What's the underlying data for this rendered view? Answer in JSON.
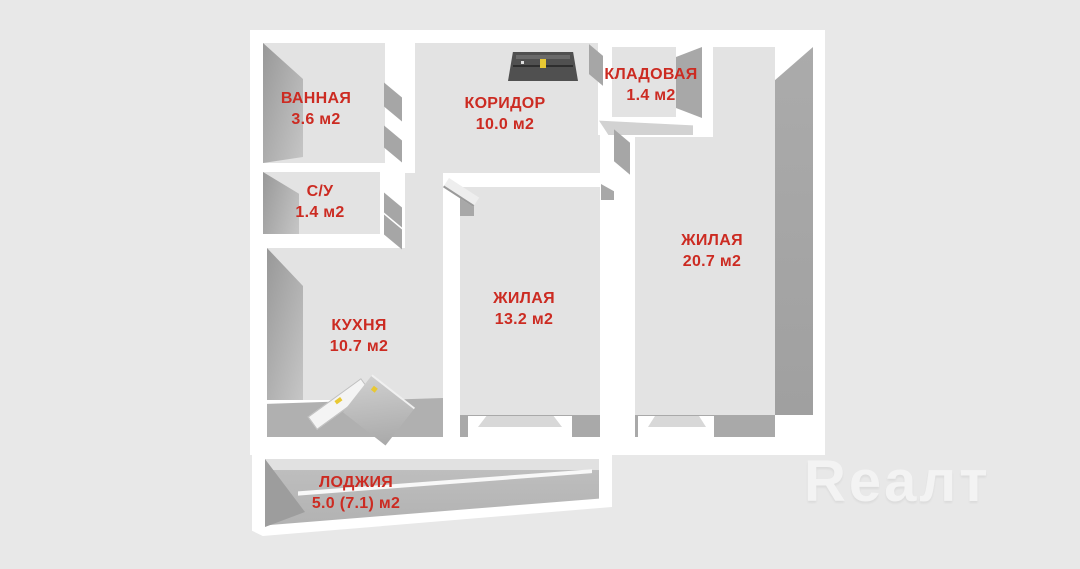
{
  "watermark": {
    "text": "Rеалт"
  },
  "colors": {
    "bg": "#e8e8e8",
    "wall": "#ffffff",
    "floor": "#e3e3e3",
    "facet": "#a8a8a8",
    "label_red": "#cc2b22",
    "door_dark": "#505050",
    "handle": "#e8c833",
    "watermark": "#f3f3f3"
  },
  "rooms": [
    {
      "key": "bathroom",
      "name": "ВАННАЯ",
      "area": "3.6 м2"
    },
    {
      "key": "wc",
      "name": "С/У",
      "area": "1.4 м2"
    },
    {
      "key": "corridor",
      "name": "КОРИДОР",
      "area": "10.0 м2"
    },
    {
      "key": "storage",
      "name": "КЛАДОВАЯ",
      "area": "1.4 м2"
    },
    {
      "key": "living_large",
      "name": "ЖИЛАЯ",
      "area": "20.7 м2"
    },
    {
      "key": "living_middle",
      "name": "ЖИЛАЯ",
      "area": "13.2 м2"
    },
    {
      "key": "kitchen",
      "name": "КУХНЯ",
      "area": "10.7 м2"
    },
    {
      "key": "loggia",
      "name": "ЛОДЖИЯ",
      "area": "5.0 (7.1) м2"
    }
  ]
}
